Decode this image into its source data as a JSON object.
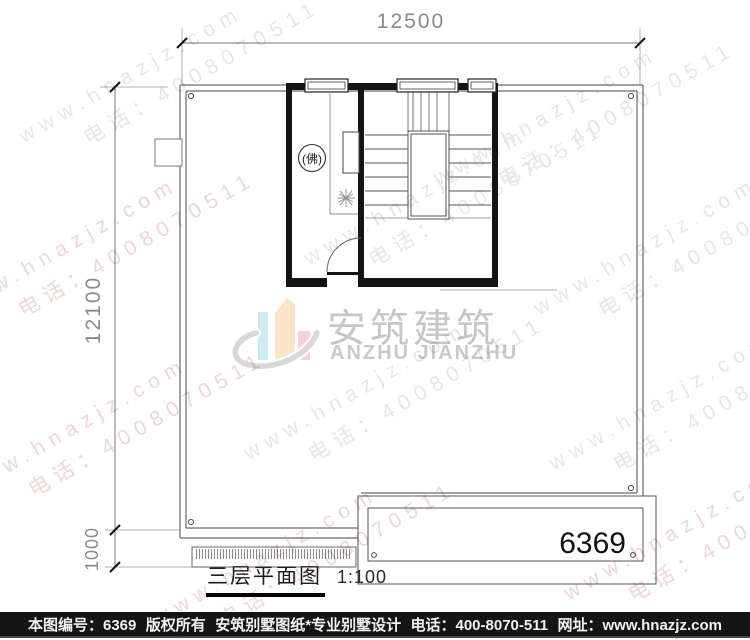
{
  "dimensions": {
    "top": "12500",
    "left": "12100",
    "left_small": "1000"
  },
  "plan": {
    "number": "6369",
    "buddha_room_label": "(佛)"
  },
  "logo": {
    "cn": "安筑建筑",
    "en": "ANZHU JIANZHU",
    "colors": {
      "bar_blue": "#cfe8f2",
      "bar_peach": "#fce4c8",
      "bar_pink": "#f7cfdd",
      "swoosh": "#d8d8db",
      "text": "#c6c6c6"
    }
  },
  "caption": {
    "title": "三层平面图",
    "scale": "1:100"
  },
  "footer": {
    "bg": "#151515",
    "fg": "#f2f2f2",
    "items": [
      "本图编号：6369",
      "版权所有",
      "安筑别墅图纸*专业别墅设计",
      "电话：400-8070-511",
      "网址：www.hnazjz.com"
    ]
  },
  "watermark": {
    "line1": "www.hnazjz.com",
    "line2": "电话：4008070511",
    "colors": {
      "gray": "#e8e5e5",
      "pink": "#eed6d6"
    },
    "items": [
      {
        "x": 15,
        "y": 128,
        "c": "gray"
      },
      {
        "x": 430,
        "y": 170,
        "c": "gray"
      },
      {
        "x": 300,
        "y": 250,
        "c": "gray"
      },
      {
        "x": -50,
        "y": 300,
        "c": "pink"
      },
      {
        "x": 530,
        "y": 300,
        "c": "gray"
      },
      {
        "x": 240,
        "y": 445,
        "c": "gray"
      },
      {
        "x": -40,
        "y": 480,
        "c": "pink"
      },
      {
        "x": 545,
        "y": 455,
        "c": "gray"
      },
      {
        "x": 560,
        "y": 585,
        "c": "pink"
      },
      {
        "x": 150,
        "y": 610,
        "c": "pink"
      }
    ]
  }
}
